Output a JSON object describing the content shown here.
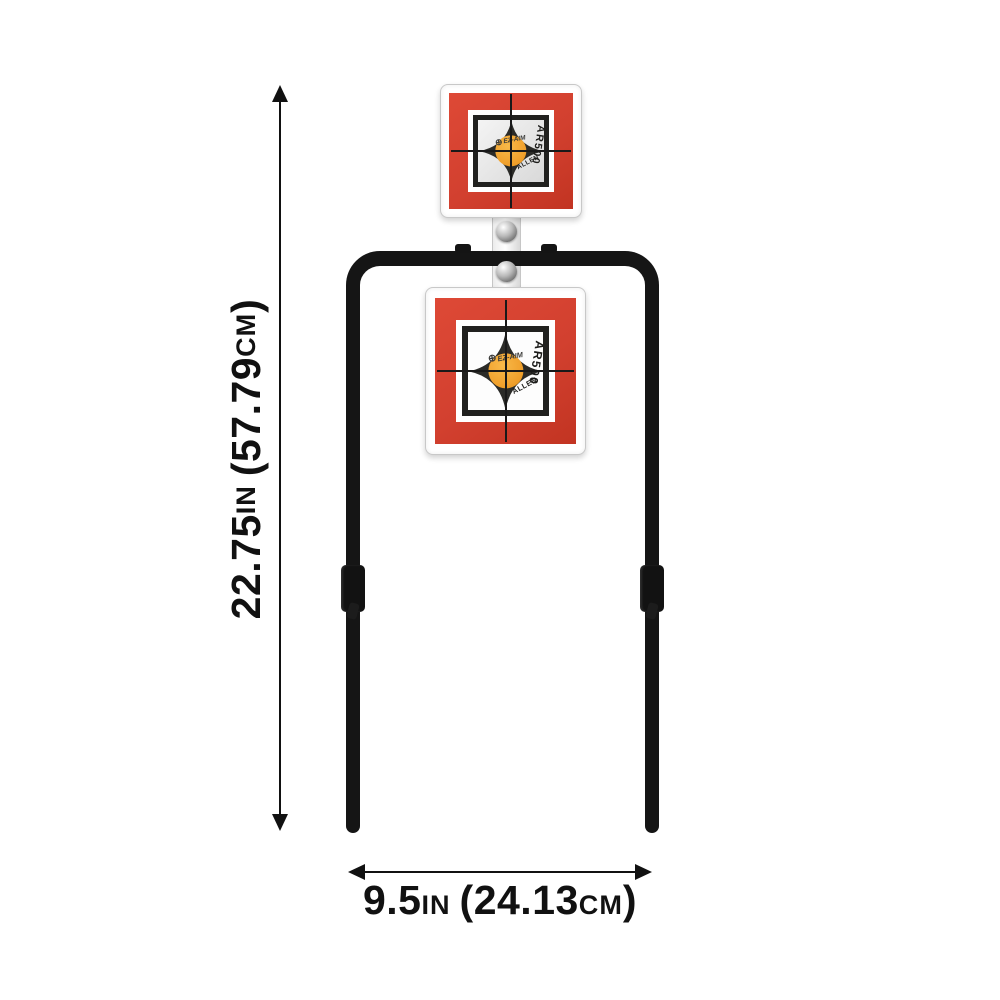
{
  "colors": {
    "red": "#d2402f",
    "orange": "#f0a02c",
    "frame_black": "#151515",
    "ink": "#111111"
  },
  "annotations": {
    "height": {
      "value_in": "22.75",
      "unit_in": "IN",
      "value_cm": "(57.79",
      "unit_cm": "CM",
      "suffix": ")"
    },
    "width": {
      "value_in": "9.5",
      "unit_in": "IN",
      "value_cm": "(24.13",
      "unit_cm": "CM",
      "suffix": ")"
    }
  },
  "target_face": {
    "logo_icon": "⊕",
    "logo": "EZ-AIM",
    "model": "AR500",
    "brand": "ALLEN"
  }
}
